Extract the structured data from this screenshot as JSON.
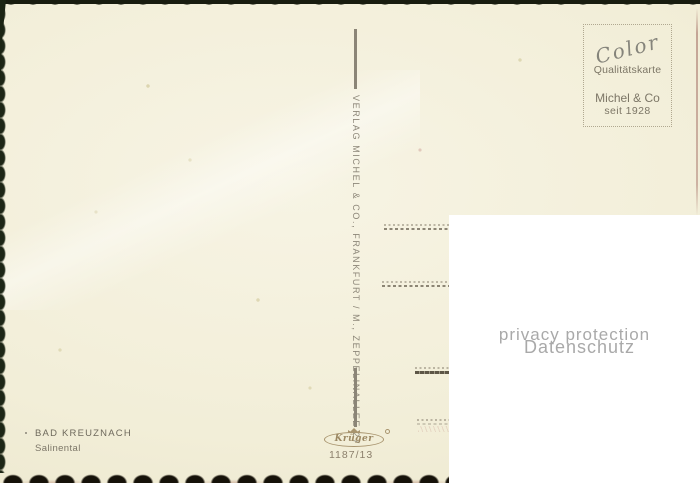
{
  "postcard": {
    "publisher_spine": "VERLAG MICHEL & CO., FRANKFURT / M., ZEPPELINALLEE 27",
    "stamp_box": {
      "brand": "Color",
      "quality_line": "Qualitätskarte",
      "company": "Michel & Co",
      "since": "seit 1928"
    },
    "caption": {
      "title": "BAD KREUZNACH",
      "subtitle": "Salinental"
    },
    "printer": {
      "logo": "Krüger",
      "card_number": "1187/13"
    },
    "colors": {
      "paper": "#f2eed8",
      "ink_gray": "#7c7666",
      "spine_ink": "#8d8779",
      "edge_dark_green": "#1d2616",
      "edge_dark_bottom": "#161209",
      "logo_brown": "#9b8762"
    }
  },
  "privacy_overlay": {
    "line1": "privacy protection",
    "line2": "Datenschutz",
    "text_color": "#a9a9a9"
  }
}
